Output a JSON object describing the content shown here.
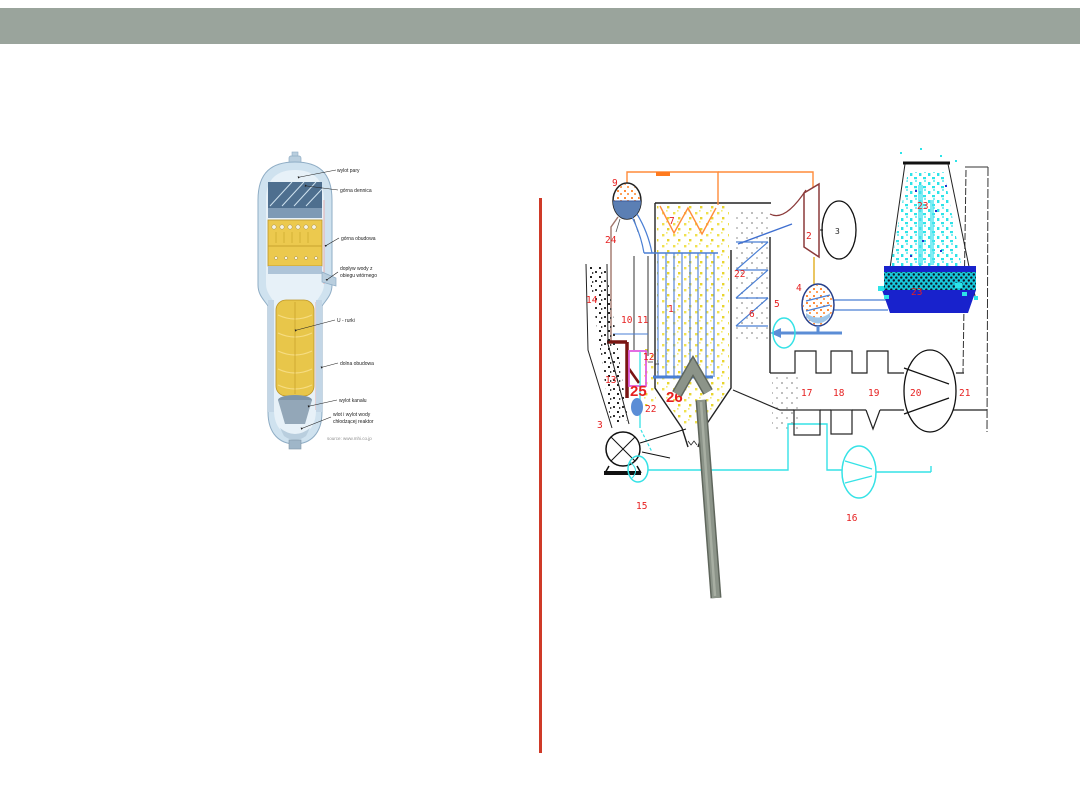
{
  "slide": {
    "background": "#ffffff",
    "header_bar_color": "#9aa49c",
    "separator_color": "#cf3a28",
    "annotation_arrow_color": "#8c9489",
    "number_red": "#e62020"
  },
  "steam_generator_figure": {
    "labels": {
      "wylot_pary": "wylot pary",
      "gorna_dennica": "górna dennica",
      "gorna_obudowa": "górna obudowa",
      "doplyw_wody_line1": "dopływ wody z",
      "doplyw_wody_line2": "obiegu wtórnego",
      "u_rurki": "U - rurki",
      "dolna_obudowa": "dolna obudowa",
      "wylot_kanalu": "wylot kanału",
      "wlot_line1": "wlot i wylot wody",
      "wlot_line2": "chłodzącej reaktor",
      "source": "source: www.mhi.co.jp"
    }
  },
  "plant_diagram": {
    "labels": {
      "n1": "1",
      "n2": "2",
      "n3_generator": "3",
      "n3_fan": "3",
      "n4": "4",
      "n5": "5",
      "n6": "6",
      "n7": "7",
      "n9": "9",
      "n10": "10",
      "n11": "11",
      "n12": "12",
      "n13": "13",
      "n14": "14",
      "n15": "15",
      "n16": "16",
      "n17": "17",
      "n18": "18",
      "n19": "19",
      "n20": "20",
      "n21": "21",
      "n22_water": "22",
      "n22_economizer": "22",
      "n23_tower_top": "23",
      "n23_tower_basin": "23",
      "n24": "24",
      "n25": "25",
      "n26": "26"
    }
  }
}
